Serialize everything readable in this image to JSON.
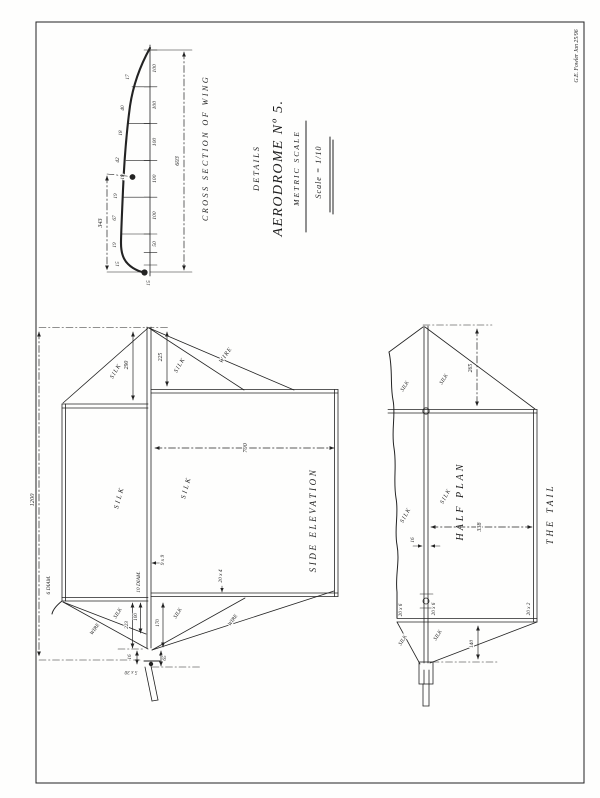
{
  "colors": {
    "paper": "#fefefd",
    "ink": "#232323"
  },
  "signature": "G.E. Fowler Jan 25/96",
  "title_block": {
    "line1": "DETAILS",
    "line2": "AERODROME Nº 5.",
    "line3": "METRIC SCALE",
    "line4": "Scale = 1/10"
  },
  "wing_section": {
    "title": "CROSS SECTION OF WING",
    "chord_total": "603",
    "camber": "343",
    "seg_100": "100",
    "seg_50": "50",
    "seg_15": "15",
    "ordinates": [
      "17",
      "40",
      "18",
      "42",
      "18",
      "19",
      "67",
      "19",
      "15"
    ]
  },
  "side_elevation": {
    "title": "SIDE ELEVATION",
    "overall_length": "1200",
    "rear_chord": "700",
    "king_post_front": "290",
    "king_post_rear": "225",
    "silk": "SILK",
    "wire": "WIRE",
    "dim_223": "223",
    "dim_100": "100",
    "dim_170": "170",
    "dim_16": "16",
    "dim_65": "65",
    "sec_9x9": "9 x 9",
    "sec_10_diam": "10 DIAM.",
    "sec_6_diam": "6 DIAM.",
    "sec_20x4": "20 x 4",
    "sec_5x30": "5 x 30"
  },
  "half_plan": {
    "title": "HALF PLAN",
    "tail_label": "THE TAIL",
    "tail_depth": "265",
    "half_span": "338",
    "spar_width": "16",
    "tip_depth": "140",
    "sec_20x6": "20 x 6",
    "sec_20x2": "20 x 2",
    "silk": "SILK"
  }
}
